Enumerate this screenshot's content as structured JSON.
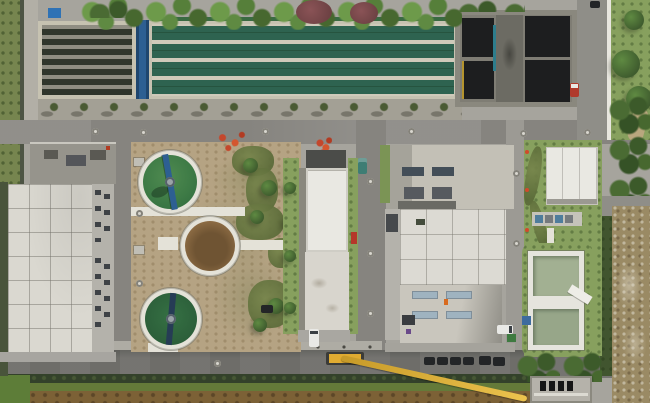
{
  "scene": {
    "type": "aerial-drone-photo",
    "subject": "wastewater-treatment-plant",
    "features": [
      "grass-verge-west",
      "aeration-basin-lanes",
      "traveling-bridge-crane",
      "sedimentation-channels",
      "tree-lined-service-road",
      "dark-roof-filter-building",
      "east-access-road",
      "walled-garden",
      "clarifier-green-north",
      "clarifier-brown-center",
      "clarifier-green-south",
      "dirt-yard-with-shrubs",
      "rooftop-plant-room",
      "large-white-workshop",
      "office-annex",
      "center-process-building",
      "main-process-building-skylights",
      "small-utility-building",
      "pump-equipment-row",
      "twin-outfall-basins",
      "construction-dirt-area",
      "mobile-crane-extended-boom",
      "parked-cars-row",
      "south-field"
    ]
  },
  "palette": {
    "base_concrete": "#a6a49d",
    "concrete_light": "#b2afa6",
    "white_roof": "#dad8d0",
    "white_roof_bright": "#e9e8e2",
    "gray_roof": "#96948c",
    "gray_annex": "#b4b2ab",
    "asphalt": "#86847f",
    "asphalt_dark": "#6e6d69",
    "frame_tan": "#c6c2b1",
    "lane_green": "#2e6350",
    "basin_dark": "#30362c",
    "black_roof": "#1d1e1f",
    "wall_gray": "#8a887e",
    "circle_rim": "#e4e2d8",
    "tank_green": "#3e7b46",
    "tank_green_dark": "#2c5f3a",
    "tank_brown": "#8d6c44",
    "tank_brown_dark": "#6f5433",
    "pale_basin": "#a2b092",
    "bridge_blue": "#2d5f92",
    "bridge_navy": "#263c55",
    "dirt_tan": "#b5a383",
    "dirt_brown": "#7c6136",
    "grass_strip": "#76854f",
    "lawn": "#87a05e",
    "hedge_dark": "#33412a",
    "tree_red": "#7e4b4b",
    "flower_red": "#c4472c",
    "crane_yellow": "#e0ab31",
    "skylight_dark": "#434e58",
    "skylight_blue": "#9fb3c0",
    "car_teal": "#3e7d74",
    "car_red": "#b03a2c",
    "car_dark": "#232527",
    "van_white": "#e9e9e6",
    "dumpster_green": "#3e7a40"
  }
}
